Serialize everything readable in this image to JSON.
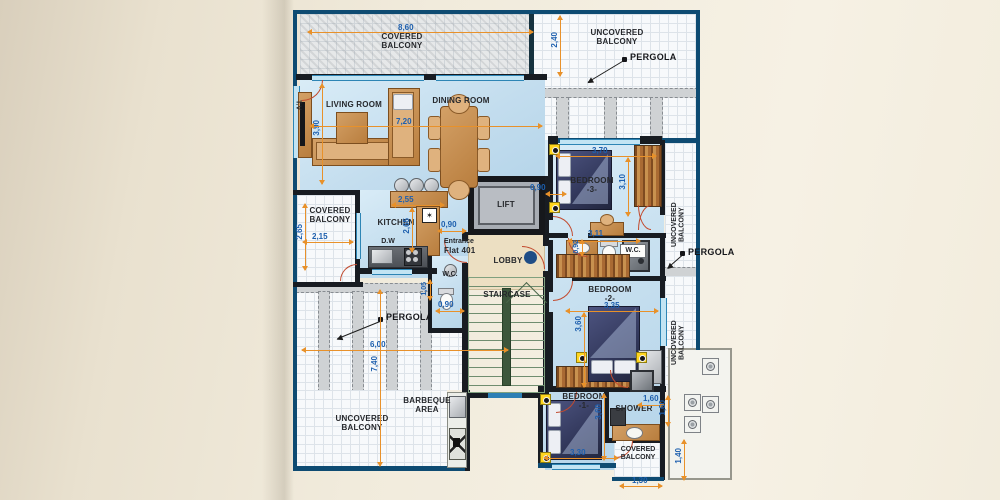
{
  "rooms": {
    "living": "LIVING ROOM",
    "dining": "DINING ROOM",
    "kitchen": "KITCHEN",
    "lift": "LIFT",
    "lobby": "LOBBY",
    "staircase": "STAIRCASE",
    "wc_small": "W.C.",
    "wc_main": "W.C.",
    "bedroom3": "BEDROOM\n-3-",
    "bedroom2": "BEDROOM\n-2-",
    "bedroom1": "BEDROOM\n-1-",
    "shower": "SHOWER"
  },
  "entrance": {
    "line1": "Entrance",
    "line2": "Flat 401"
  },
  "balconies": {
    "covered_top": "COVERED\nBALCONY",
    "uncovered_top": "UNCOVERED\nBALCONY",
    "covered_left": "COVERED\nBALCONY",
    "uncovered_right_upper": "UNCOVERED\nBALCONY",
    "uncovered_right_lower": "UNCOVERED\nBALCONY",
    "uncovered_bottom": "UNCOVERED\nBALCONY",
    "covered_bottom_right": "COVERED\nBALCONY"
  },
  "areas": {
    "barbeque": "BARBEQUE\nAREA"
  },
  "pergola": {
    "top": "PERGOLA",
    "right": "PERGOLA",
    "left": "PERGOLA"
  },
  "fixtures": {
    "tv": "T.V",
    "dw": "D.W",
    "star": "✶"
  },
  "dimensions": {
    "top_width": "8,60",
    "top_depth": "2,40",
    "living_height": "3,90",
    "living_width": "7,20",
    "kitchen_width": "2,55",
    "kitchen_depth": "2,65",
    "balcony_left_depth": "2,65",
    "balcony_left_width": "2,15",
    "lift_left": "0,90",
    "lift_right": "0,90",
    "bed3_width": "3,70",
    "bed3_depth": "3,10",
    "wc_width": "3,11",
    "wc_depth": "0,92",
    "bed2_width": "3,35",
    "bed2_depth": "3,60",
    "wc_small_width": "0,90",
    "wc_small_depth": "1,05",
    "pergola_width": "6,00",
    "terrace_depth": "7,40",
    "bed1_width": "3,30",
    "bed1_depth": "3,60",
    "shower_width": "1,60",
    "shower_depth": "1,60",
    "cb_br_depth": "1,40",
    "cb_br_width": "1,30"
  }
}
